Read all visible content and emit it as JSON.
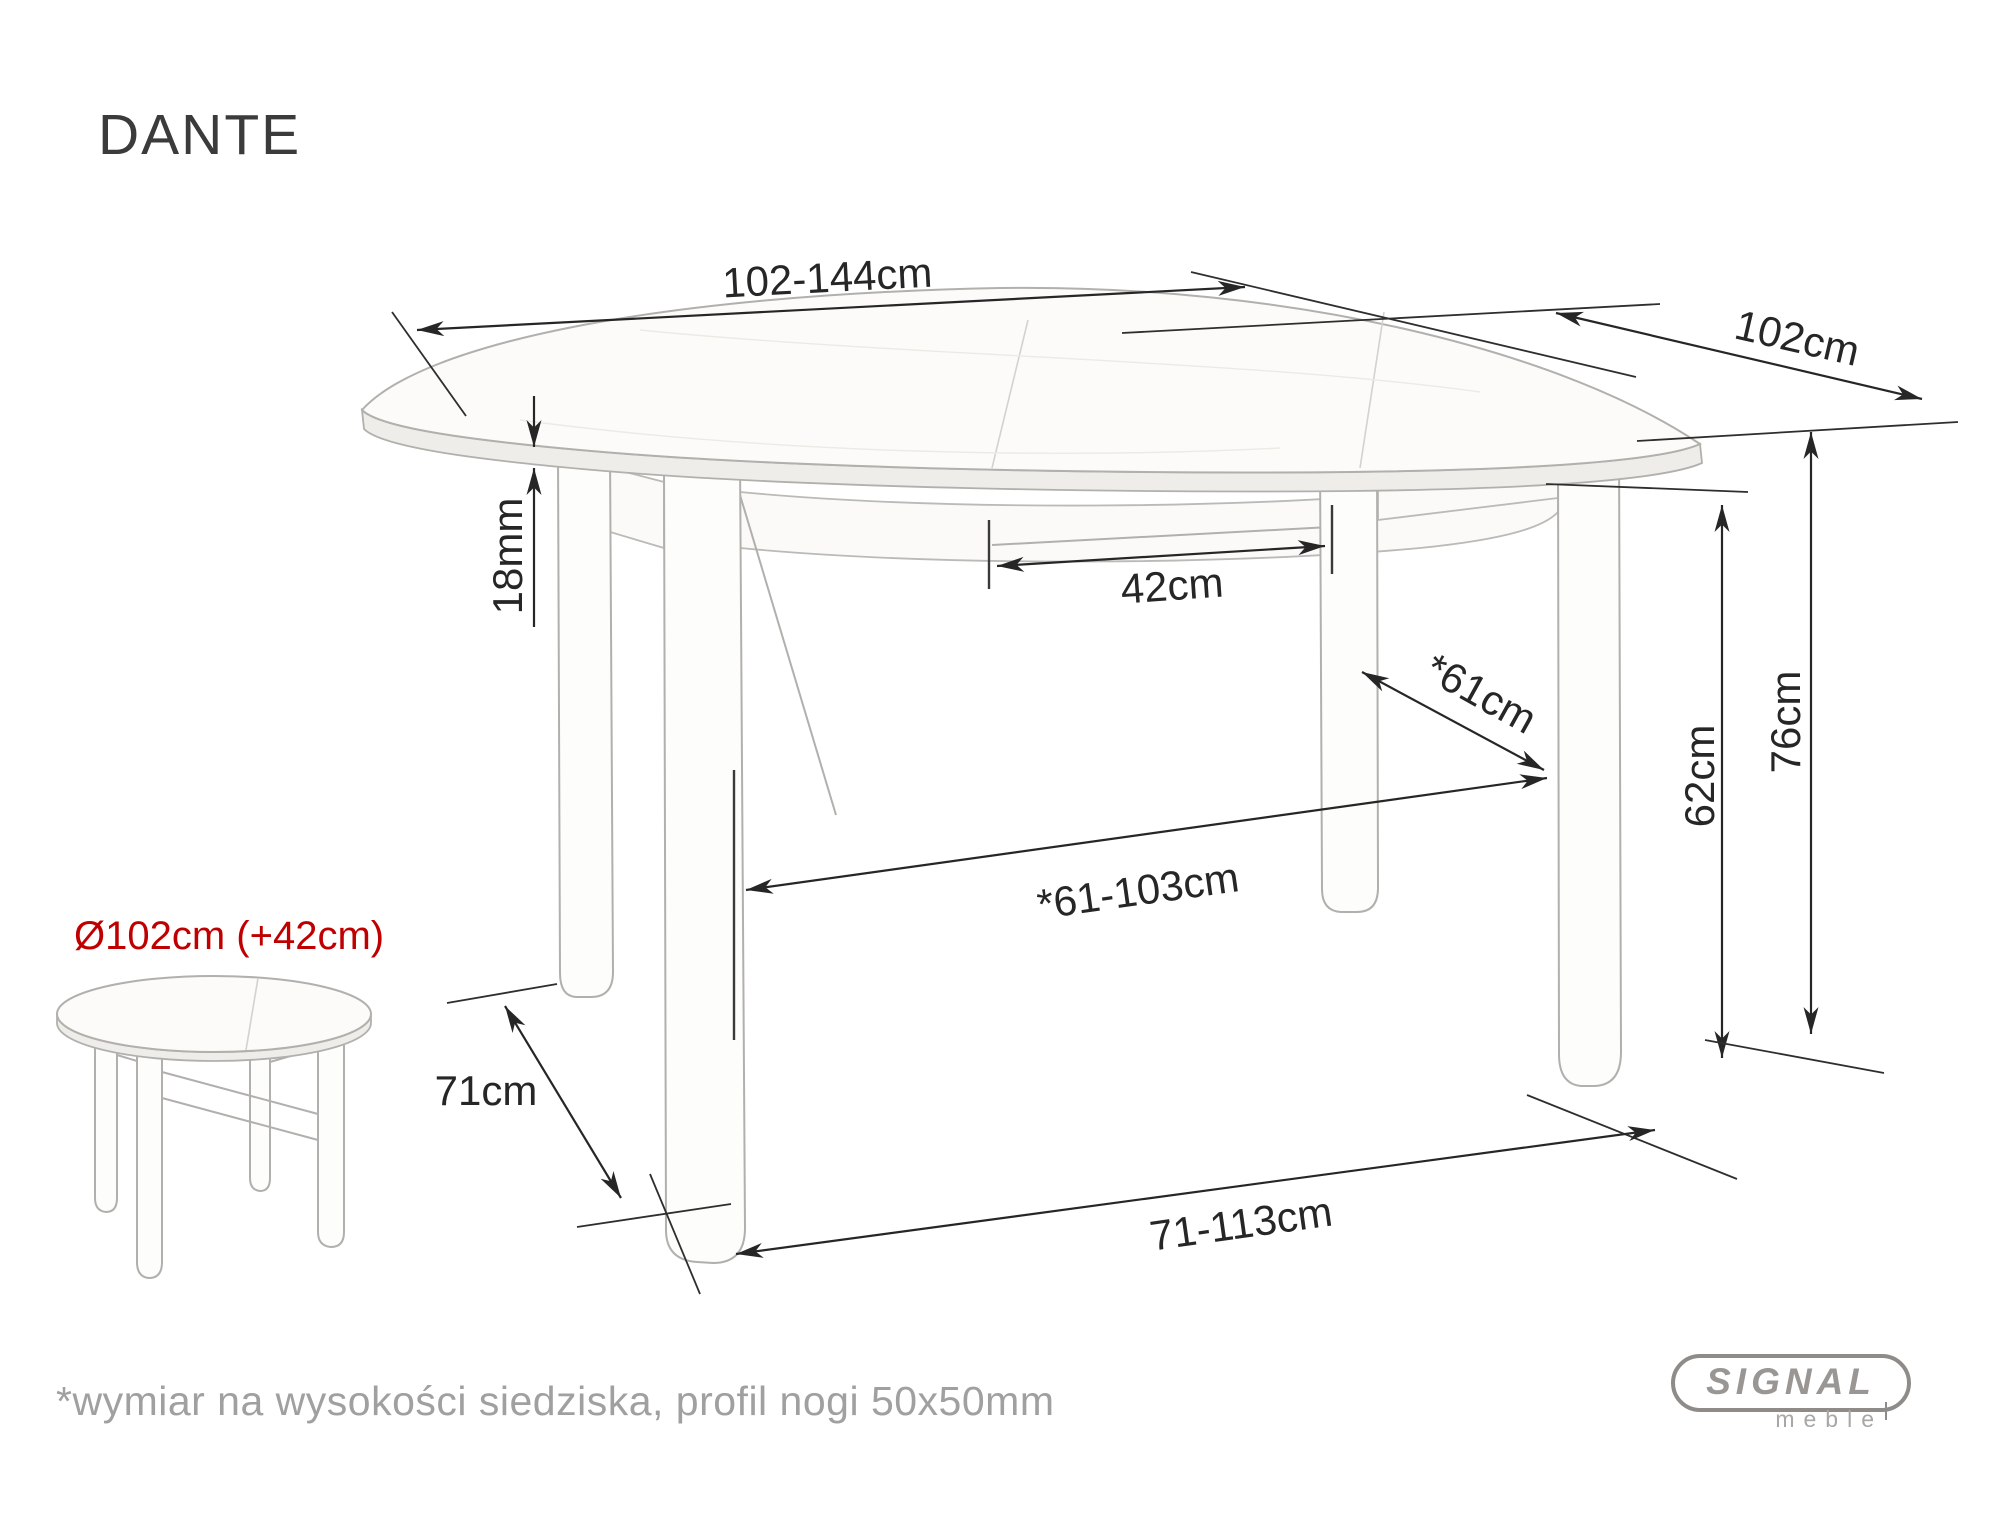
{
  "product": {
    "name": "DANTE",
    "small_view_label": "Ø102cm (+42cm)",
    "note": "*wymiar na wysokości siedziska, profil nogi 50x50mm"
  },
  "dims": {
    "top_width": "102-144cm",
    "top_depth": "102cm",
    "top_thickness": "18mm",
    "extension_leaf": "42cm",
    "inner_depth": "*61cm",
    "apron_to_floor": "62cm",
    "height": "76cm",
    "leg_span_depth": "71cm",
    "inner_width": "*61-103cm",
    "leg_span_width": "71-113cm"
  },
  "logo": {
    "brand": "SIGNAL",
    "sub": "meble"
  },
  "colors": {
    "background": "#ffffff",
    "dimension_line": "#262626",
    "drawing_outline": "#b2b0ad",
    "accent_red": "#c00000",
    "muted_text": "#a0a0a0",
    "logo_gray": "#96938f"
  }
}
